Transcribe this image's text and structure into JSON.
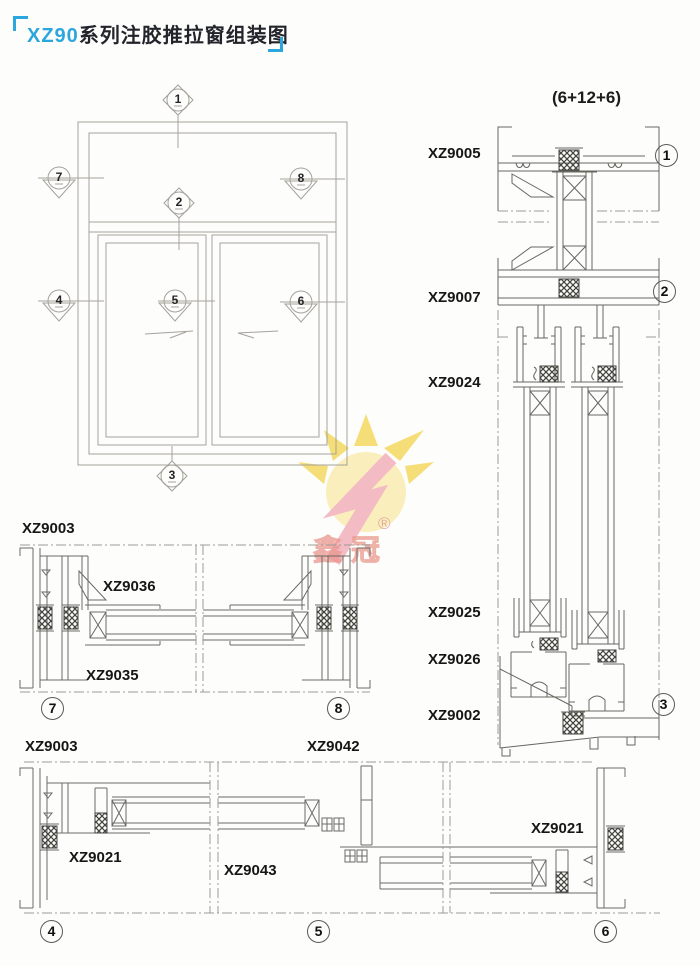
{
  "title": {
    "series": "XZ90",
    "rest": "系列注胶推拉窗组装图"
  },
  "glass_spec": "(6+12+6)",
  "watermark": {
    "brand": "鑫冠",
    "registered": "®"
  },
  "elevation_markers": [
    "1",
    "2",
    "3",
    "4",
    "5",
    "6",
    "7",
    "8"
  ],
  "right_column": {
    "profile_labels": [
      "XZ9005",
      "XZ9007",
      "XZ9024",
      "XZ9025",
      "XZ9026",
      "XZ9002"
    ],
    "detail_numbers": [
      "1",
      "2",
      "3"
    ]
  },
  "jamb_section": {
    "profile_labels": [
      "XZ9003",
      "XZ9036",
      "XZ9035"
    ],
    "detail_numbers": [
      "7",
      "8"
    ]
  },
  "sill_section": {
    "profile_labels": [
      "XZ9003",
      "XZ9042",
      "XZ9021",
      "XZ9043",
      "XZ9021"
    ],
    "detail_numbers": [
      "4",
      "5",
      "6"
    ]
  }
}
